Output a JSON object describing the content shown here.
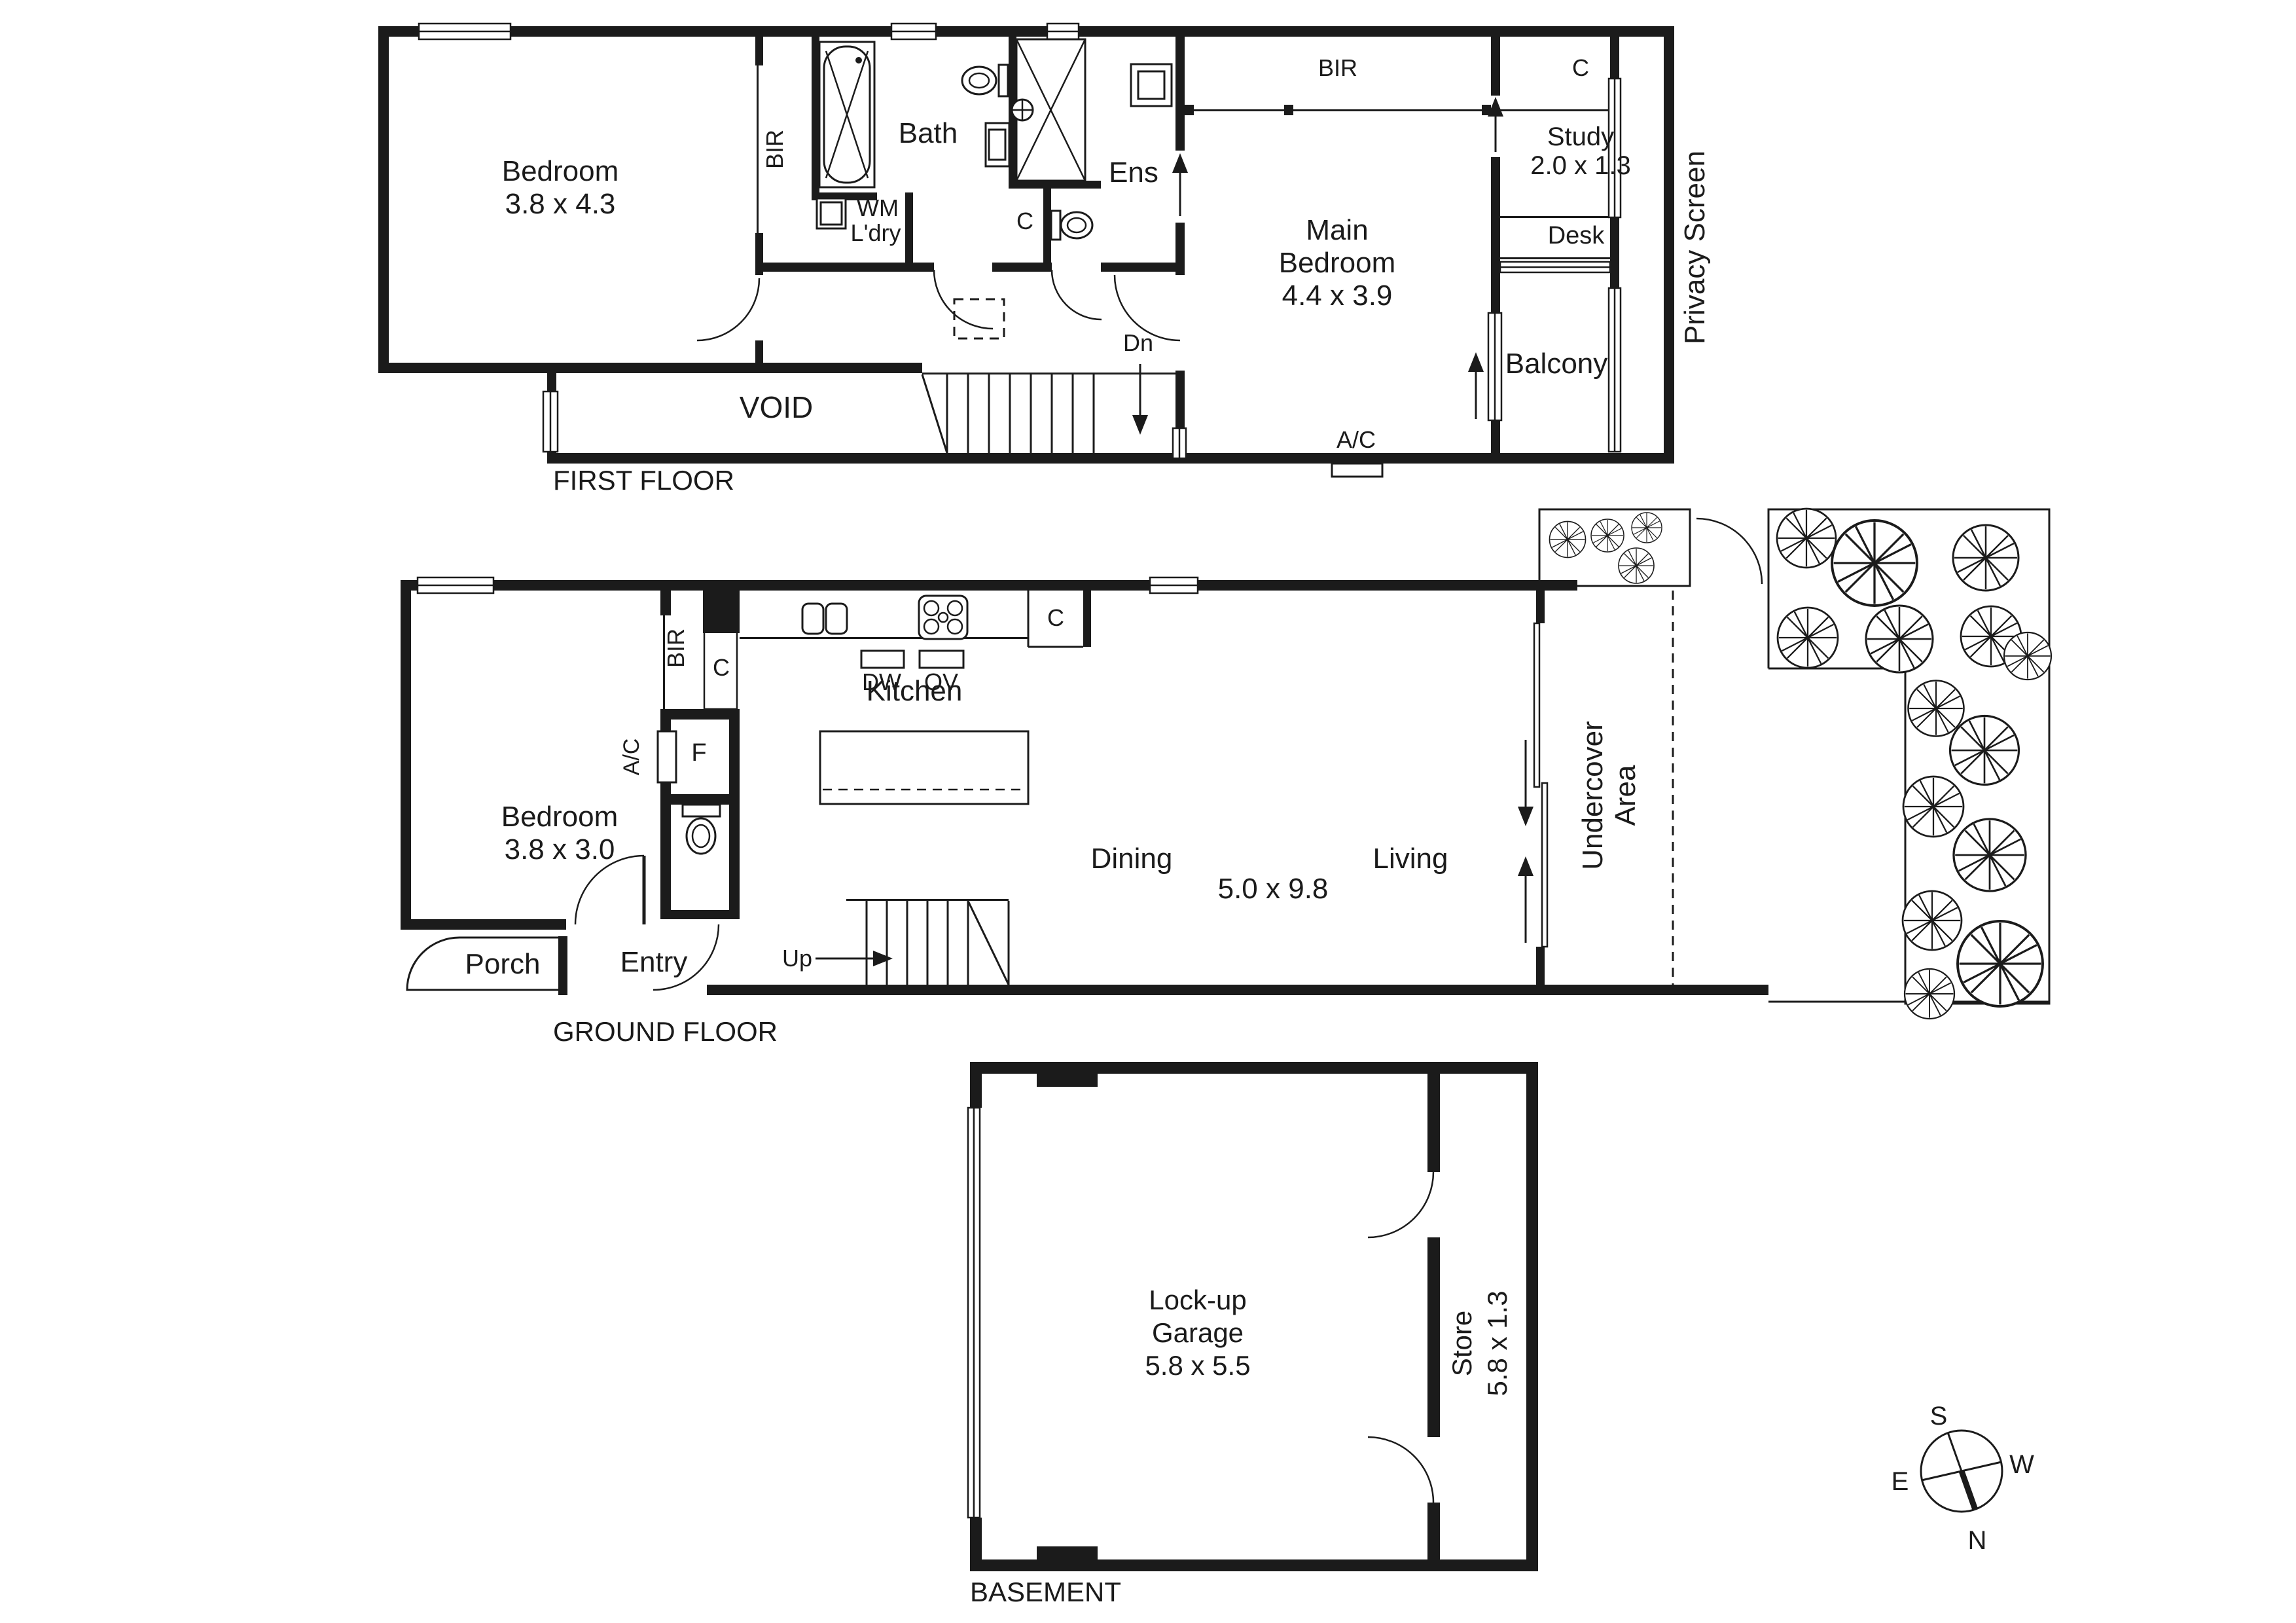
{
  "first_floor": {
    "floor_label": "FIRST FLOOR",
    "bedroom_name": "Bedroom",
    "bedroom_dims": "3.8 x 4.3",
    "bir_left": "BIR",
    "bath": "Bath",
    "wm": "WM",
    "ldry": "L'dry",
    "ens": "Ens",
    "wc_closet": "C",
    "main_bedroom_line1": "Main",
    "main_bedroom_line2": "Bedroom",
    "main_bedroom_dims": "4.4 x 3.9",
    "bir_top": "BIR",
    "closet_top": "C",
    "study_name": "Study",
    "study_dims": "2.0 x 1.3",
    "desk": "Desk",
    "balcony": "Balcony",
    "void": "VOID",
    "down": "Dn",
    "ac": "A/C",
    "privacy_screen": "Privacy Screen"
  },
  "ground_floor": {
    "floor_label": "GROUND FLOOR",
    "bedroom_name": "Bedroom",
    "bedroom_dims": "3.8 x 3.0",
    "bir": "BIR",
    "closet_hall": "C",
    "ac": "A/C",
    "fridge": "F",
    "kitchen": "Kitchen",
    "dishwasher": "DW",
    "oven": "OV",
    "closet_kitchen": "C",
    "dining": "Dining",
    "living_dims": "5.0 x 9.8",
    "living": "Living",
    "undercover_line1": "Undercover",
    "undercover_line2": "Area",
    "porch": "Porch",
    "entry": "Entry",
    "up": "Up"
  },
  "basement": {
    "floor_label": "BASEMENT",
    "garage_line1": "Lock-up",
    "garage_line2": "Garage",
    "garage_dims": "5.8 x 5.5",
    "store_name": "Store",
    "store_dims": "5.8 x 1.3"
  },
  "compass": {
    "north": "N",
    "south": "S",
    "east": "E",
    "west": "W"
  }
}
